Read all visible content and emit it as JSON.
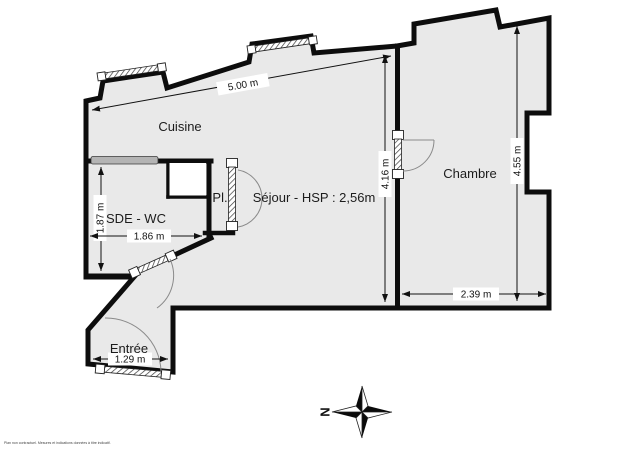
{
  "plan": {
    "rooms": {
      "cuisine": "Cuisine",
      "sde_wc": "SDE - WC",
      "placard": "Pl.",
      "sejour": "Séjour - HSP : 2,56m",
      "chambre": "Chambre",
      "entree": "Entrée"
    },
    "dimensions": {
      "top_width": "5.00 m",
      "sejour_height": "4.16 m",
      "chambre_height": "4.55 m",
      "chambre_width": "2.39 m",
      "sde_height": "1.87 m",
      "sde_width": "1.86 m",
      "entree_width": "1.29 m"
    },
    "compass": {
      "north": "N"
    },
    "footer": {
      "disclaimer": "Plan non contractuel. Mesures et indications données à titre indicatif."
    },
    "colors": {
      "floor": "#e9e9e9",
      "wall": "#0d0d0d",
      "gray_bar": "#b4b4b4"
    }
  }
}
